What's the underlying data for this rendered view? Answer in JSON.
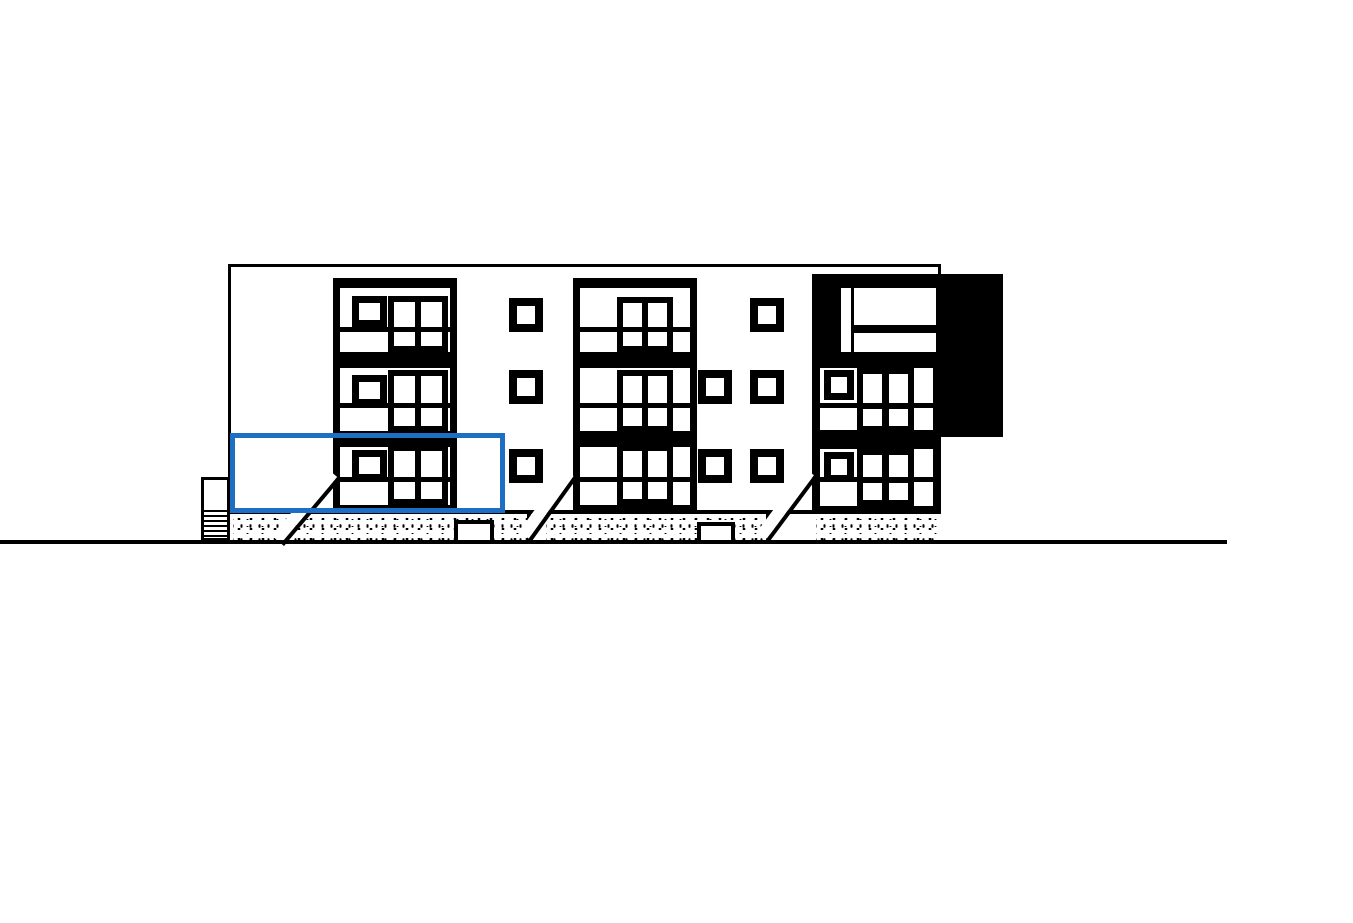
{
  "figure": {
    "kind": "architectural-elevation-drawing",
    "building": {
      "sections": 3,
      "floors": 3,
      "features": [
        "window-stacks",
        "small-wall-windows",
        "dark-roof-annex",
        "foundation-hatching",
        "entrance-ramps",
        "side-stairs",
        "ground-line"
      ]
    },
    "selection": {
      "shape": "rectangle",
      "location": "ground-floor-left-bay"
    },
    "colors": {
      "background": "#FFFFFF",
      "linework": "#000000",
      "fill": "#000000",
      "selection": "#1E6FC4"
    }
  }
}
